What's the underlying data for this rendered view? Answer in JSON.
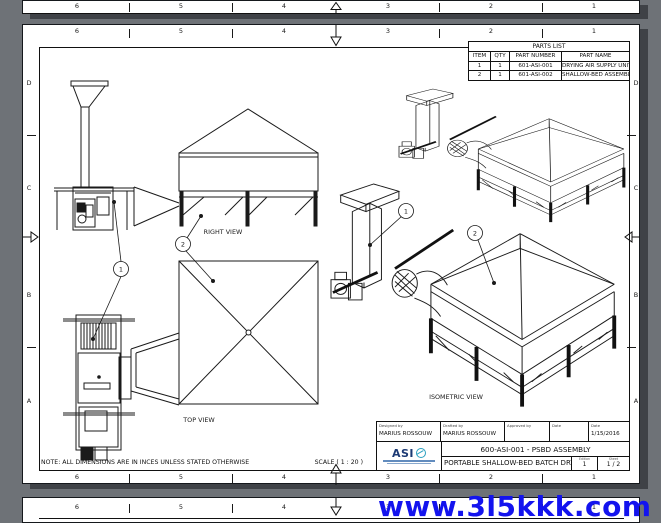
{
  "viewer": {
    "watermark": "www.3l5kkk.com"
  },
  "sheet": {
    "columns": [
      "6",
      "5",
      "4",
      "3",
      "2",
      "1"
    ],
    "rows": [
      "D",
      "C",
      "B",
      "A"
    ],
    "note": "NOTE: ALL DIMENSIONS ARE IN INCES UNLESS STATED OTHERWISE",
    "scale": "SCALE ( 1 : 20 )"
  },
  "parts_list": {
    "title": "PARTS LIST",
    "headers": [
      "ITEM",
      "QTY",
      "PART NUMBER",
      "PART NAME"
    ],
    "rows": [
      [
        "1",
        "1",
        "601-ASI-001",
        "DRYING AIR SUPPLY UNIT"
      ],
      [
        "2",
        "1",
        "601-ASI-002",
        "SHALLOW-BED ASSEMBLY"
      ]
    ]
  },
  "views": {
    "right": "RIGHT VIEW",
    "top": "TOP VIEW",
    "isometric": "ISOMETRIC VIEW"
  },
  "callouts": {
    "item1": "1",
    "item2": "2"
  },
  "title_block": {
    "designed_label": "Designed by",
    "designed": "MARIUS ROSSOUW",
    "drafted_label": "Drafted by",
    "drafted": "MARIUS ROSSOUW",
    "approved_label": "Approved by",
    "approved": "",
    "date1_label": "Date",
    "date1": "",
    "date2_label": "Date",
    "date2": "1/15/2016",
    "logo": "ASI",
    "number": "600-ASI-001 - PSBD ASSEMBLY",
    "title": "PORTABLE SHALLOW-BED BATCH DRYER",
    "edition_label": "Edition",
    "edition": "1",
    "sheet_label": "Sheet",
    "sheet": "1 / 2"
  },
  "colors": {
    "background": "#6e7277",
    "watermark": "#1313ee",
    "line": "#1a1a1a",
    "logo_blue": "#1c3a74",
    "logo_teal": "#2ba0c0",
    "shadow": "#3f4247"
  }
}
